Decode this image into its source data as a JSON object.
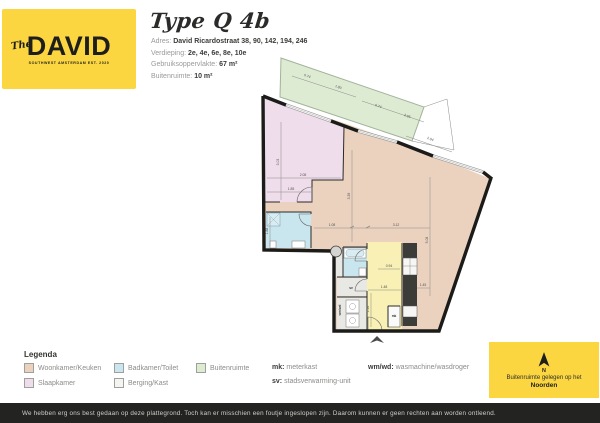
{
  "logo": {
    "the": "The",
    "name": "DAVID",
    "tagline": "SOUTHWEST AMSTERDAM EST. 2020"
  },
  "header": {
    "title": "Type Q 4b",
    "fields": [
      {
        "label": "Adres:",
        "value": "David Ricardostraat 38, 90, 142, 194, 246"
      },
      {
        "label": "Verdieping:",
        "value": "2e, 4e, 6e, 8e, 10e"
      },
      {
        "label": "Gebruiksoppervlakte:",
        "value": "67 m²"
      },
      {
        "label": "Buitenruimte:",
        "value": "10 m²"
      }
    ]
  },
  "floorplan": {
    "colors": {
      "living": "#EBD2BF",
      "bedroom": "#EFDDEB",
      "bath": "#C9E5EE",
      "hall": "#F8F0B4",
      "balcony": "#DEEBD3",
      "storage": "#E8E8E5",
      "wall": "#1B1B19",
      "kitchen_dark": "#3C3C39"
    },
    "labels": {
      "mk": "mk",
      "sv": "sv",
      "wmwd": "wm/wd"
    },
    "dimensions": [
      "0.74",
      "1.80",
      "0.74",
      "2.05",
      "2.94",
      "3.03",
      "2.08",
      "1.85",
      "3.39",
      "5.08",
      "1.08",
      "3.12",
      "1.16",
      "1.48",
      "1.45",
      "0.94",
      "1.88"
    ]
  },
  "legend": {
    "title": "Legenda",
    "items": [
      {
        "label": "Woonkamer/Keuken",
        "color": "#EBD2BF"
      },
      {
        "label": "Slaapkamer",
        "color": "#EFDDEB"
      },
      {
        "label": "Badkamer/Toilet",
        "color": "#C9E5EE"
      },
      {
        "label": "Berging/Kast",
        "color": "#F4F4F1"
      },
      {
        "label": "Buitenruimte",
        "color": "#DEEBD3"
      }
    ],
    "abbrev": [
      {
        "key": "mk:",
        "text": "meterkast"
      },
      {
        "key": "sv:",
        "text": "stadsverwarming-unit"
      },
      {
        "key": "wm/wd:",
        "text": "wasmachine/wasdroger"
      }
    ]
  },
  "northbox": {
    "line1": "Buitenruimte gelegen op het",
    "line2": "Noorden"
  },
  "colors": {
    "yellow": "#FBD640",
    "bar": "#232321"
  },
  "footer": {
    "text": "We hebben erg ons best gedaan op deze plattegrond. Toch kan er misschien een foutje ingeslopen zijn. Daarom kunnen er geen rechten aan worden ontleend."
  }
}
